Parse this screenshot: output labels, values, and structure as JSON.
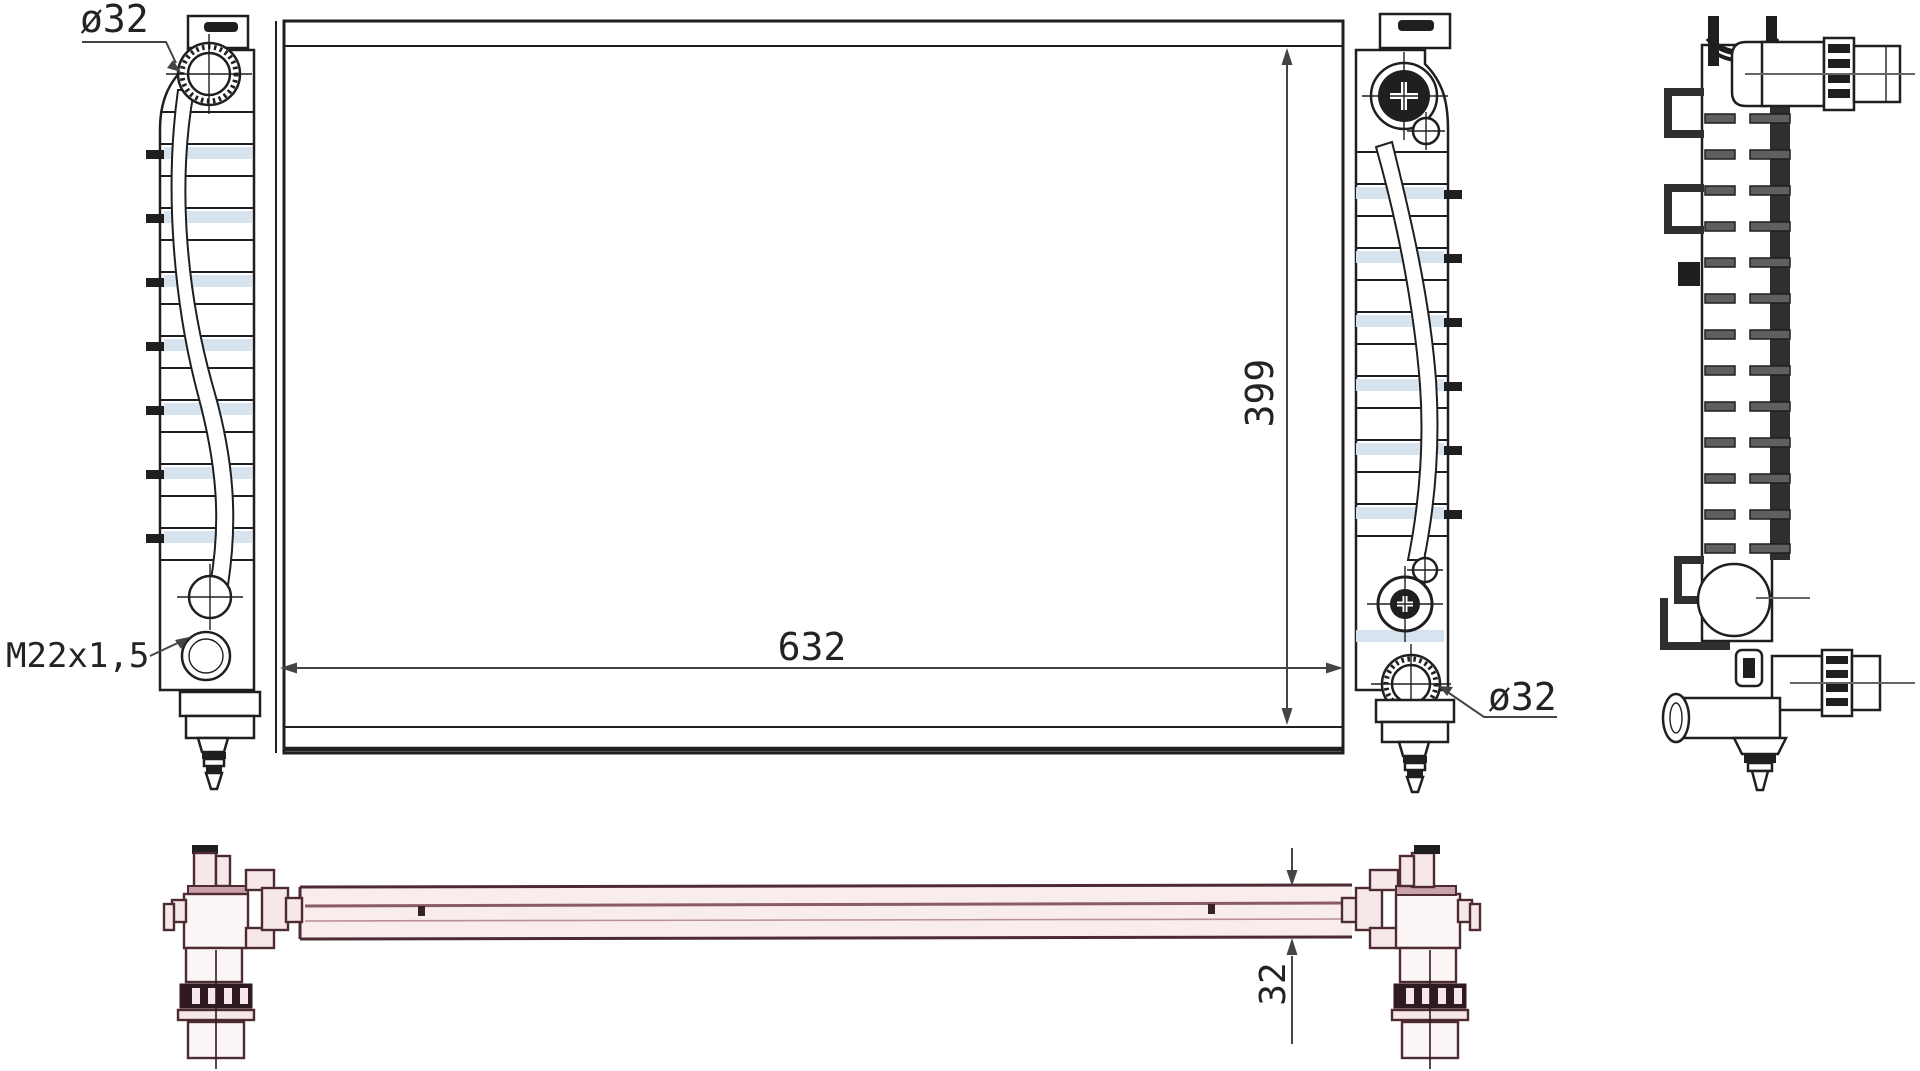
{
  "watermark": {
    "text": "ALVADI",
    "color": "#e2e2e2"
  },
  "drawing": {
    "type": "radiator-technical-drawing",
    "annotations": {
      "inlet_diameter_label": "ø32",
      "outlet_diameter_label": "ø32",
      "drain_thread_label": "M22x1,5",
      "width_dimension": "632",
      "height_dimension": "399",
      "tube_depth_dimension": "32"
    },
    "colors": {
      "line": "#1f1f1f",
      "dimension": "#444444",
      "fin_blue": "#d7e3ef",
      "tube_pink_fill": "#f8ecec",
      "tube_pink_line": "#4e2b33",
      "background": "#ffffff"
    }
  }
}
